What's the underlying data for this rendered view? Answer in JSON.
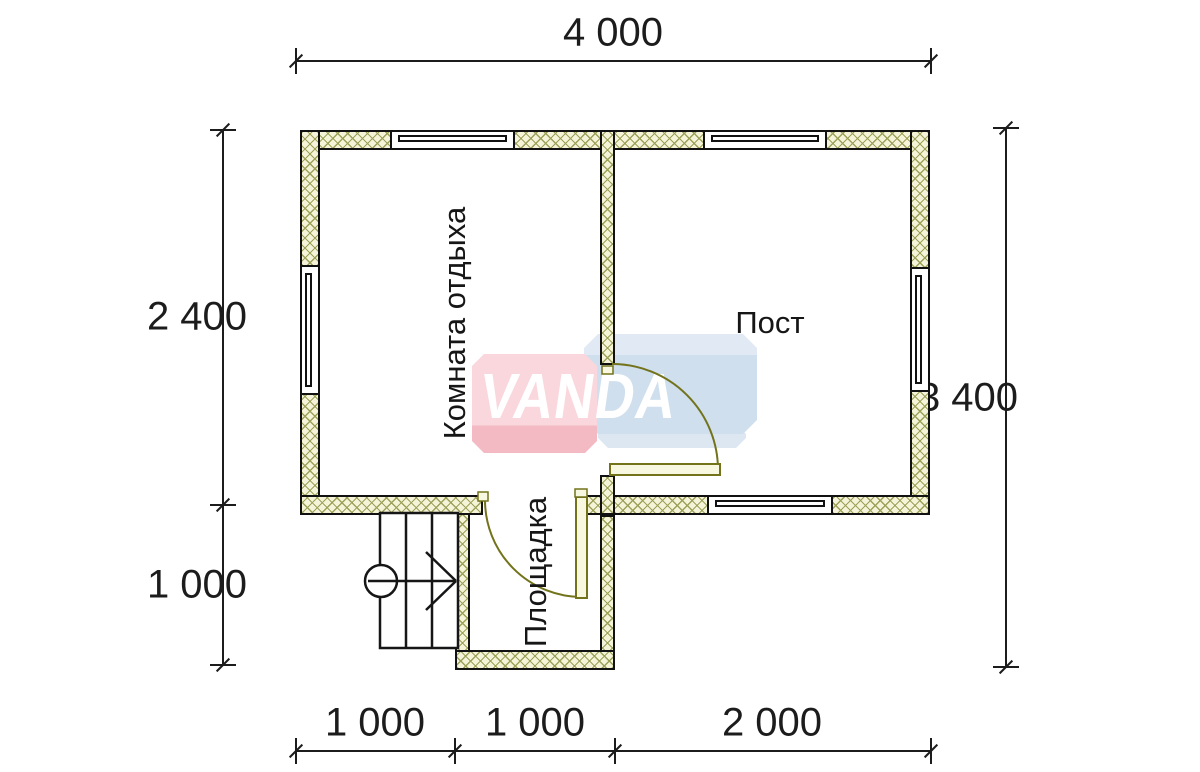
{
  "watermark": {
    "text": "VANDA",
    "pink": "#f4bac4",
    "blue": "#cfdfee"
  },
  "rooms": {
    "rest": {
      "label": "Комната отдыха"
    },
    "post": {
      "label": "Пост"
    },
    "porch": {
      "label": "Площадка"
    }
  },
  "dimensions": {
    "top": {
      "label": "4 000"
    },
    "left": [
      {
        "label": "2 400"
      },
      {
        "label": "1 000"
      }
    ],
    "right": {
      "label": "3 400"
    },
    "bottom": [
      {
        "label": "1 000"
      },
      {
        "label": "1 000"
      },
      {
        "label": "2 000"
      }
    ]
  },
  "colors": {
    "background": "#ffffff",
    "wall_fill": "#f5f3d8",
    "wall_hatch": "#9ba158",
    "wall_outline": "#111111",
    "door": "#73731c",
    "dimension_lines": "#1c1c1c"
  }
}
